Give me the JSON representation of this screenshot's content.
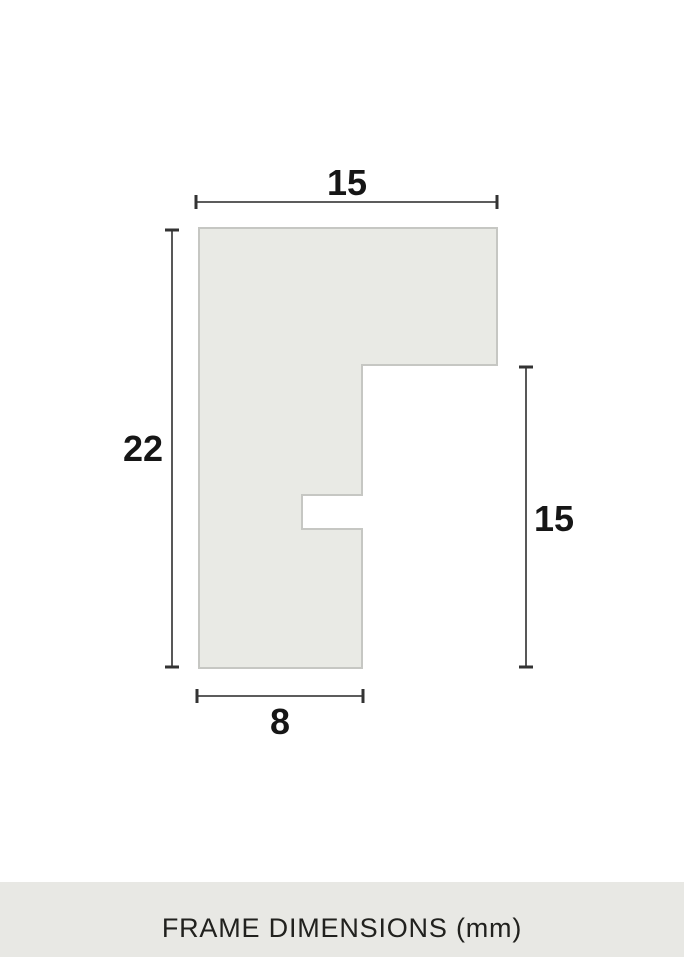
{
  "page": {
    "background_color": "#ffffff"
  },
  "diagram": {
    "type": "frame-profile-cross-section",
    "unit": "mm",
    "profile": {
      "fill_color": "#e9eae5",
      "stroke_color": "#c6c7c3"
    },
    "dimensions": {
      "top_width": {
        "label": "15",
        "value": 15
      },
      "left_height": {
        "label": "22",
        "value": 22
      },
      "right_height": {
        "label": "15",
        "value": 15
      },
      "bottom_width": {
        "label": "8",
        "value": 8
      }
    },
    "line_color": "#454545",
    "label_color": "#161616"
  },
  "footer": {
    "title": "FRAME DIMENSIONS (mm)",
    "background_color": "#e8e8e4",
    "text_color": "#21211e"
  }
}
